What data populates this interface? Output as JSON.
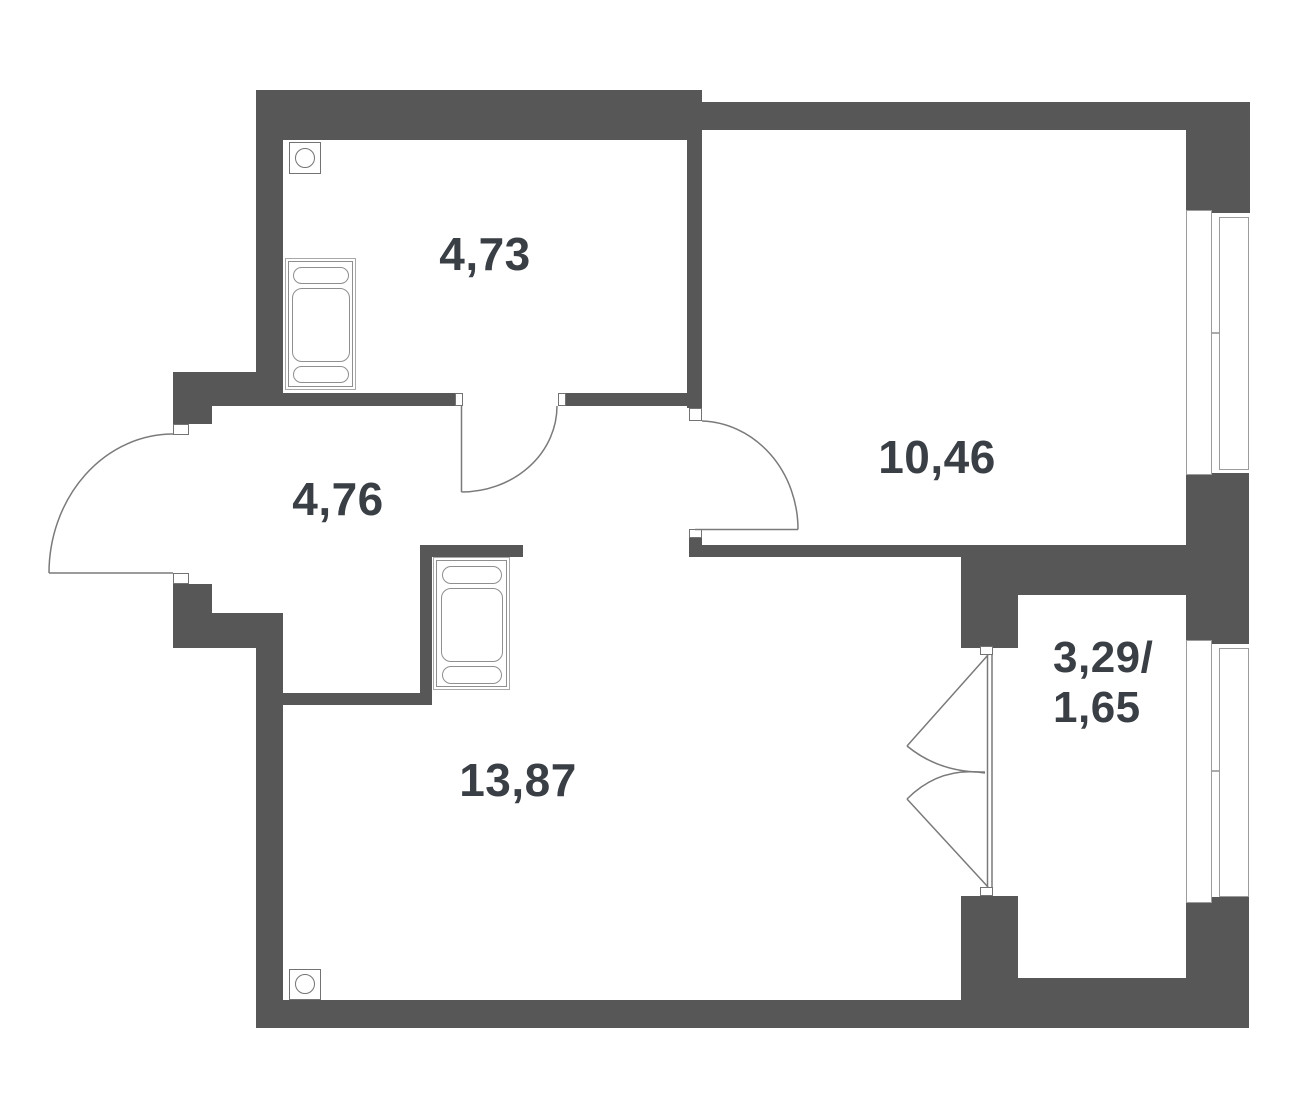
{
  "plan": {
    "title": "apartment-floor-plan",
    "colors": {
      "wall": "#575757",
      "thin_line": "#7a7a7a",
      "furniture_line": "#8f8f8f",
      "text": "#3a3f45"
    },
    "rooms": [
      {
        "id": "bedroom",
        "area_label": "4,73"
      },
      {
        "id": "living-room",
        "area_label": "10,46"
      },
      {
        "id": "hallway",
        "area_label": "4,76"
      },
      {
        "id": "main-room",
        "area_label": "13,87"
      },
      {
        "id": "balcony",
        "area_label_line1": "3,29/",
        "area_label_line2": "1,65"
      }
    ],
    "icons": {
      "vent": "circle-in-square ventilation symbol",
      "door_arc": "quarter-circle door swing",
      "window": "double-pane window strip"
    }
  }
}
